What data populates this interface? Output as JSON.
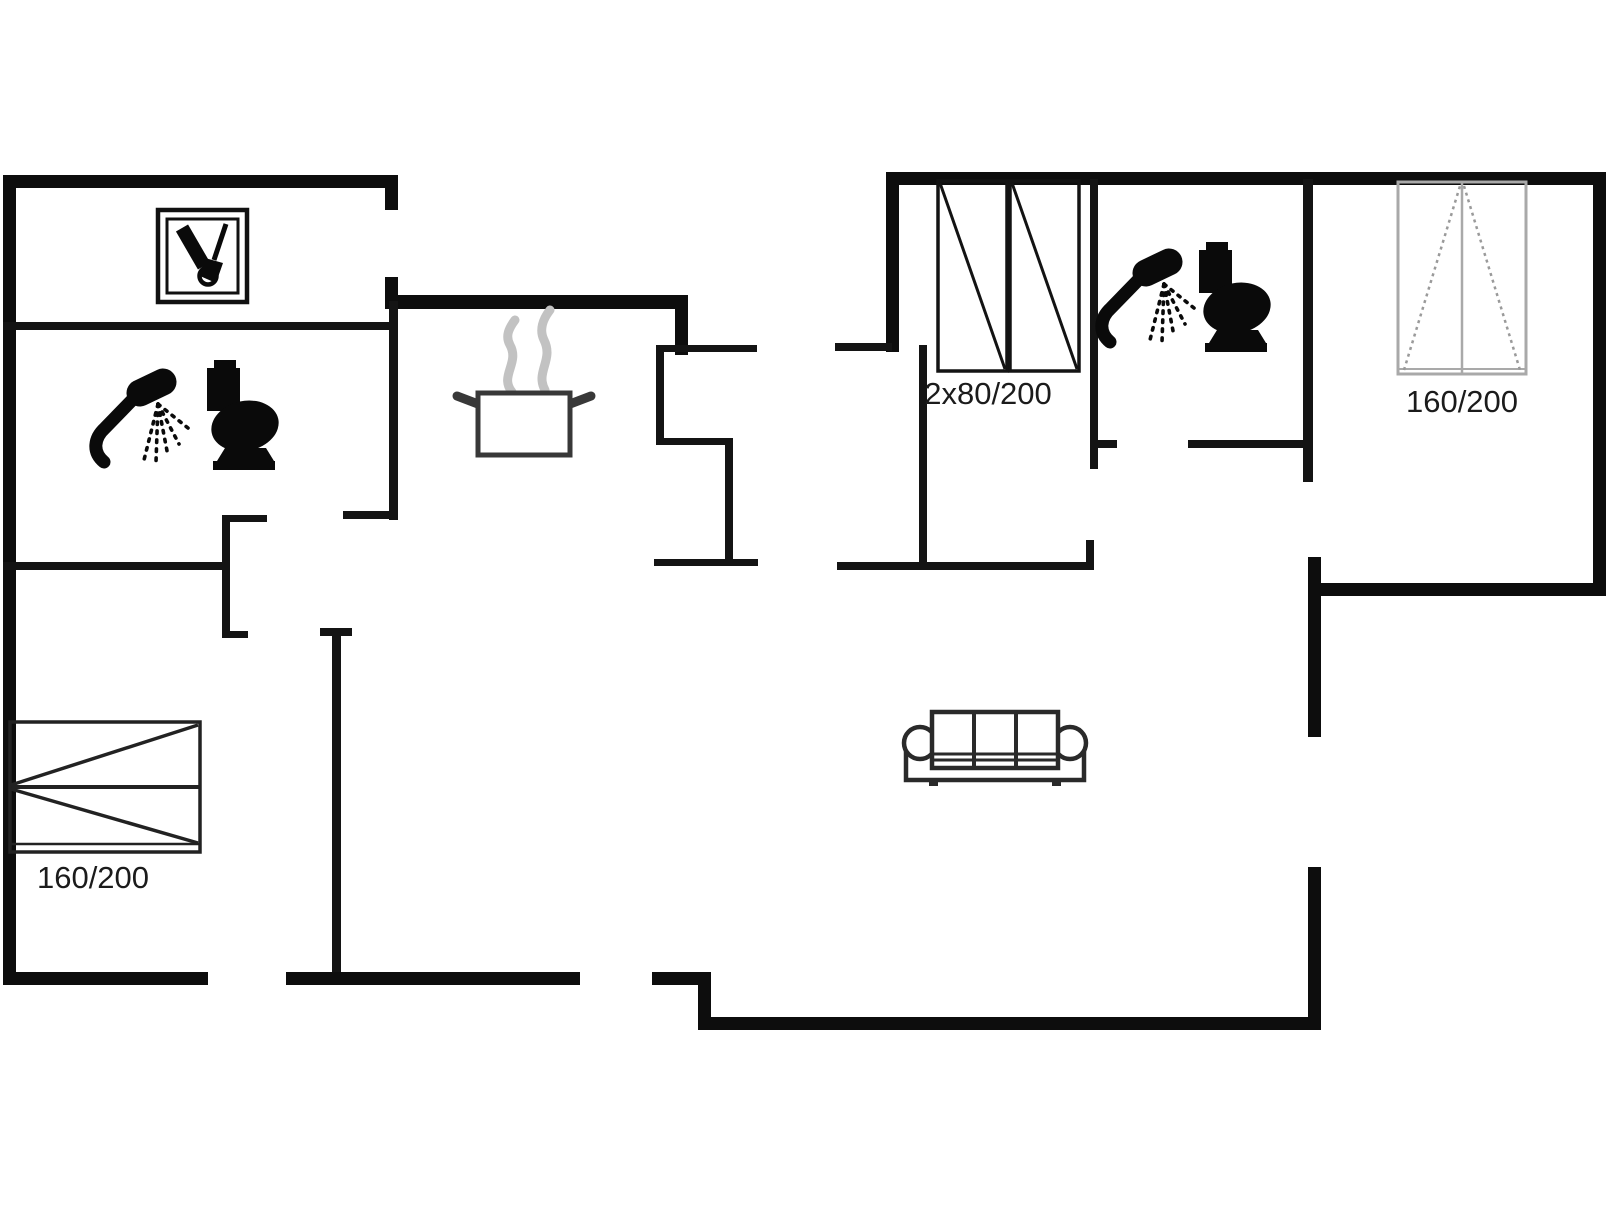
{
  "page": {
    "type": "floor-plan",
    "bg": "#ffffff",
    "wall_color": "#0d0d0d",
    "interior_wall_color": "#141414",
    "width": 1606,
    "height": 1205
  },
  "labels": [
    {
      "id": "wardrobe-size",
      "text": "2x80/200",
      "x": 988,
      "y": 404,
      "size": 31,
      "anchor": "middle"
    },
    {
      "id": "bed-right-size",
      "text": "160/200",
      "x": 1462,
      "y": 412,
      "size": 31,
      "anchor": "middle"
    },
    {
      "id": "bed-left-size",
      "text": "160/200",
      "x": 93,
      "y": 888,
      "size": 31,
      "anchor": "middle"
    }
  ],
  "walls": {
    "thick": [
      [
        3,
        175,
        13,
        810
      ],
      [
        3,
        175,
        394,
        13
      ],
      [
        385,
        175,
        13,
        35
      ],
      [
        385,
        277,
        13,
        32
      ],
      [
        385,
        295,
        303,
        14
      ],
      [
        675,
        295,
        13,
        60
      ],
      [
        3,
        972,
        205,
        13
      ],
      [
        286,
        972,
        294,
        13
      ],
      [
        652,
        972,
        59,
        13
      ],
      [
        698,
        972,
        13,
        58
      ],
      [
        698,
        1017,
        623,
        13
      ],
      [
        1308,
        867,
        13,
        163
      ],
      [
        1308,
        557,
        13,
        180
      ],
      [
        1308,
        583,
        298,
        13
      ],
      [
        1593,
        175,
        13,
        421
      ],
      [
        886,
        172,
        720,
        13
      ],
      [
        886,
        172,
        13,
        180
      ]
    ],
    "thin": [
      [
        3,
        322,
        392,
        8
      ],
      [
        389,
        301,
        9,
        219
      ],
      [
        343,
        511,
        55,
        8
      ],
      [
        3,
        562,
        220,
        8
      ],
      [
        222,
        515,
        45,
        7
      ],
      [
        222,
        515,
        8,
        123
      ],
      [
        222,
        631,
        26,
        7
      ],
      [
        320,
        628,
        32,
        8
      ],
      [
        332,
        628,
        9,
        344
      ],
      [
        656,
        345,
        101,
        7
      ],
      [
        656,
        345,
        8,
        100
      ],
      [
        656,
        438,
        77,
        7
      ],
      [
        725,
        438,
        8,
        128
      ],
      [
        654,
        559,
        104,
        7
      ],
      [
        835,
        343,
        57,
        8
      ],
      [
        919,
        345,
        8,
        225
      ],
      [
        837,
        562,
        256,
        8
      ],
      [
        1086,
        540,
        8,
        30
      ],
      [
        1090,
        179,
        8,
        290
      ],
      [
        1090,
        440,
        27,
        8
      ],
      [
        1188,
        440,
        122,
        8
      ],
      [
        1303,
        179,
        10,
        303
      ]
    ]
  },
  "furniture": {
    "washing_box": {
      "name": "utility-cabinet-icon",
      "x": 158,
      "y": 210,
      "w": 89,
      "h": 92
    },
    "shower_1": {
      "name": "shower-icon",
      "x": 96,
      "y": 368
    },
    "toilet_1": {
      "name": "toilet-icon",
      "x": 198,
      "y": 360
    },
    "shower_2": {
      "name": "shower-icon",
      "x": 1102,
      "y": 248
    },
    "toilet_2": {
      "name": "toilet-icon",
      "x": 1190,
      "y": 242
    },
    "pot": {
      "name": "stove-pot-icon",
      "x": 452,
      "y": 310
    },
    "sofa": {
      "name": "sofa-icon",
      "x": 903,
      "y": 710
    },
    "bed_left": {
      "name": "double-bed-icon",
      "x": 10,
      "y": 722,
      "w": 190,
      "h": 130,
      "stroke": "#222222"
    },
    "bed_right": {
      "name": "double-bed-icon",
      "x": 1398,
      "y": 182,
      "w": 128,
      "h": 192,
      "stroke": "#a9a9a9",
      "diag": "#9a9a9a"
    },
    "wardrobe": {
      "name": "wardrobe-icon",
      "x": 938,
      "y": 181,
      "unit_w": 69,
      "h": 190,
      "gap": 3,
      "count": 2,
      "stroke": "#131313"
    }
  },
  "icon_colors": {
    "fixture_fill": "#0a0a0a",
    "pot_stroke": "#383838",
    "steam": "#c2c2c2",
    "sofa_stroke": "#2a2a2a"
  }
}
